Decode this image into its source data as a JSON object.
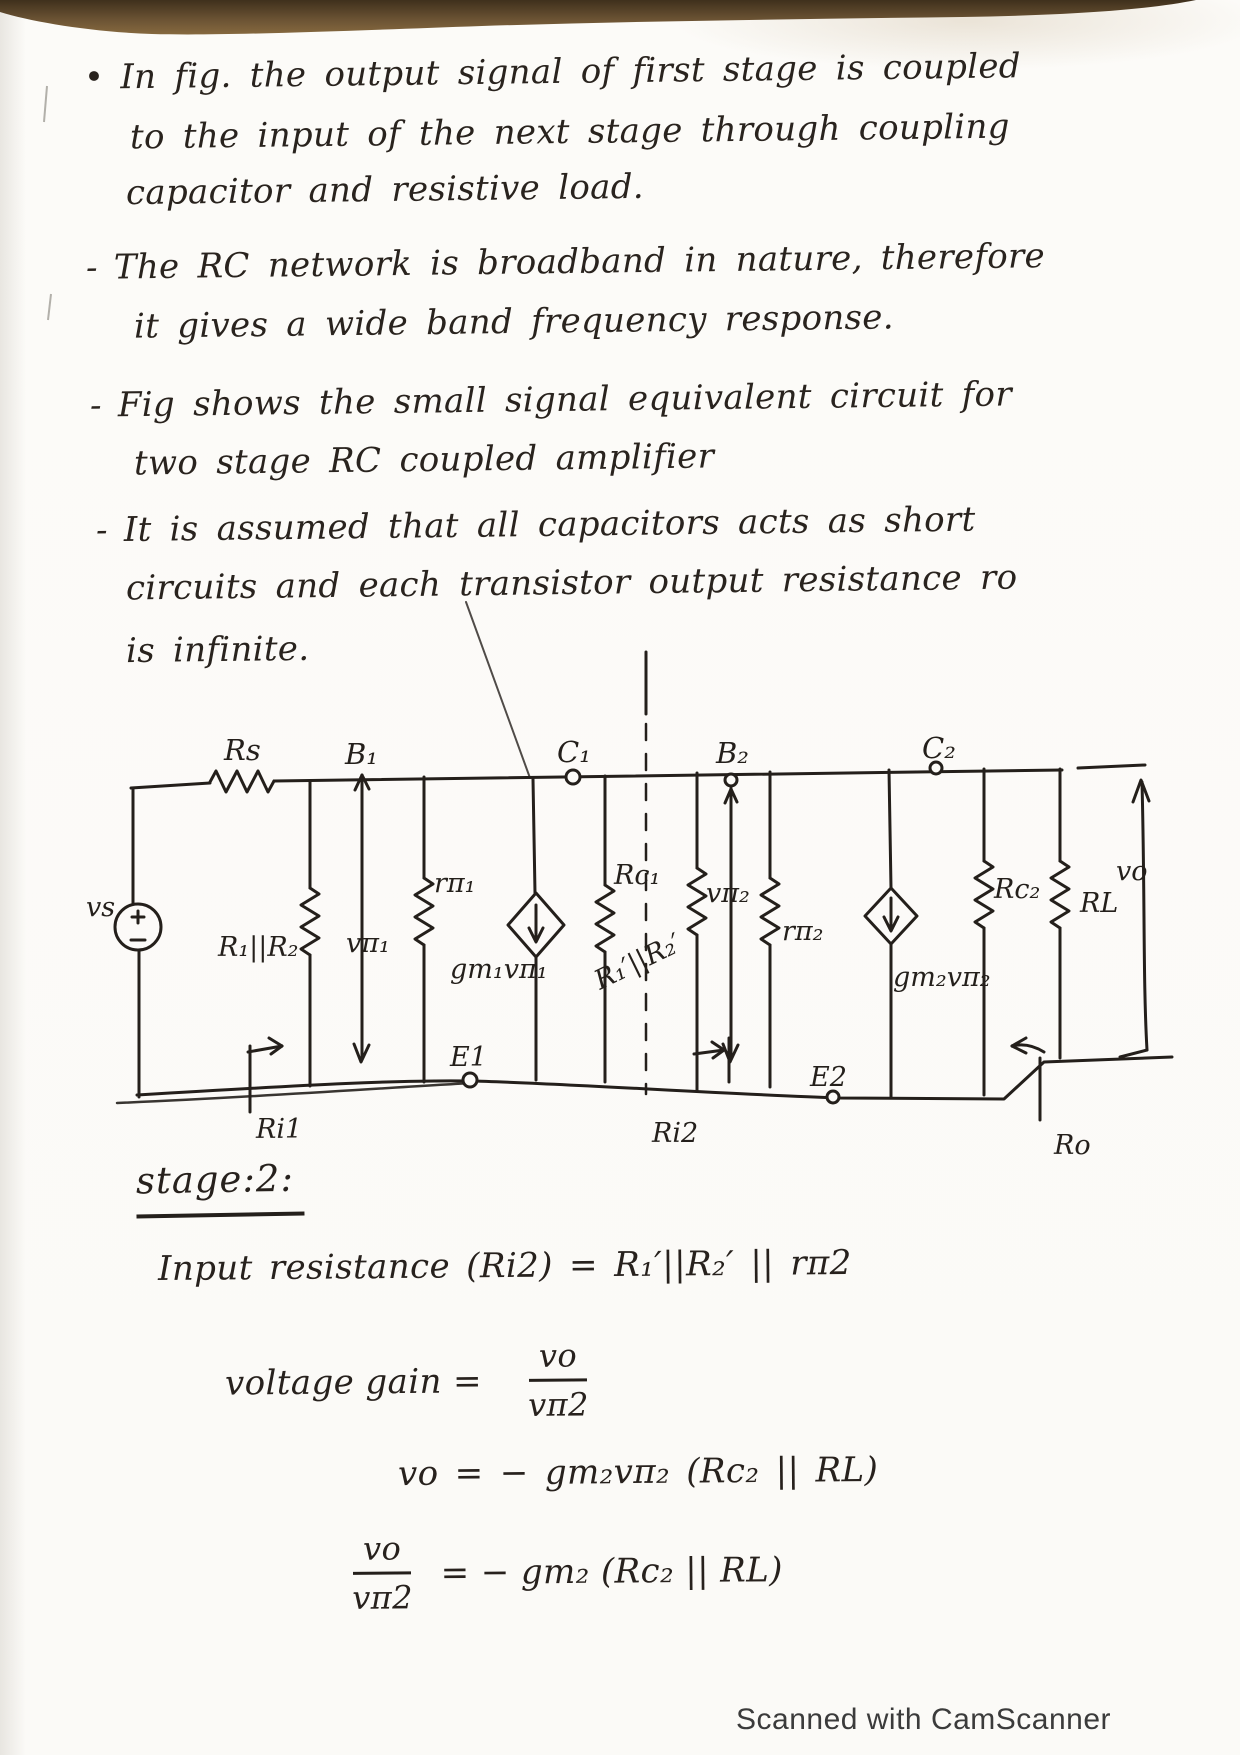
{
  "colors": {
    "ink": "#27211d",
    "paper": "#fcfbf8",
    "top_band": "#5e4a2d",
    "footer_text": "#3b3b3b"
  },
  "notes": {
    "bullets": [
      {
        "marker": "•",
        "lines": [
          "In fig. the output signal of first stage is coupled",
          "to the input of the next stage through coupling",
          "capacitor and resistive load."
        ]
      },
      {
        "marker": "-",
        "lines": [
          "The RC network is broadband in nature, therefore",
          "it gives a wide band frequency response."
        ]
      },
      {
        "marker": "-",
        "lines": [
          "Fig shows the small signal equivalent circuit for",
          "two stage RC coupled amplifier"
        ]
      },
      {
        "marker": "-",
        "lines": [
          "It is assumed that all capacitors acts as short",
          "circuits and each transistor output resistance ro",
          "is infinite."
        ]
      }
    ]
  },
  "circuit": {
    "labels": {
      "vs": "vs",
      "rs": "Rs",
      "b1": "B₁",
      "c1": "C₁",
      "b2": "B₂",
      "c2": "C₂",
      "r1r2": "R₁||R₂",
      "vpi1": "vπ₁",
      "rpi1": "rπ₁",
      "gm1vpi1": "gm₁vπ₁",
      "rc1": "Rc₁",
      "r1r2p": "R₁′||R₂′",
      "vpi2": "vπ₂",
      "rpi2": "rπ₂",
      "gm2vpi2": "gm₂vπ₂",
      "rc2": "Rc₂",
      "rl": "RL",
      "vo": "vo",
      "e1": "E1",
      "e2": "E2",
      "ri1": "Ri1",
      "ri2": "Ri2",
      "ro": "Ro"
    }
  },
  "stage2": {
    "heading": "stage:2:",
    "input_resistance": "Input resistance (Ri2) = R₁′||R₂′ || rπ2",
    "gain_label": "voltage gain =",
    "gain_num": "vo",
    "gain_den": "vπ2",
    "eq_vo": "vo = − gm₂vπ₂ (Rc₂ || RL)",
    "ratio_num": "vo",
    "ratio_den": "vπ2",
    "ratio_rhs": "= − gm₂ (Rc₂ || RL)"
  },
  "scan": {
    "footer": "Scanned with CamScanner"
  }
}
